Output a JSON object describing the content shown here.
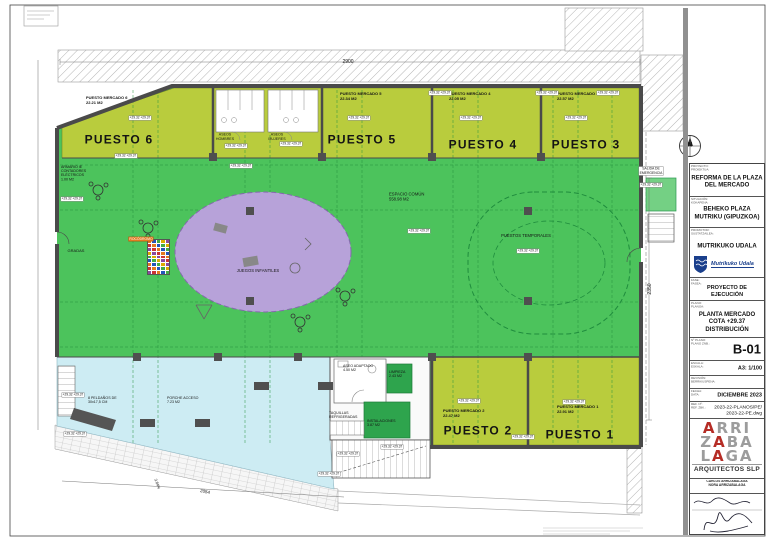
{
  "colors": {
    "stall_yellow": "#b9cc3d",
    "hall_green": "#4cc35c",
    "room_green": "#2ea44d",
    "exit_green": "#74d084",
    "play_purple": "#b7a2d9",
    "terrace_cyan": "#cdecf3",
    "wall_gray": "#4a4a4a",
    "tag_orange": "#e2791f",
    "brand_red": "#b52c25",
    "brand_gray": "#9c9c9c",
    "logo_blue": "#1a3f8c"
  },
  "plan": {
    "level_tag_text": "+29.32 +29.37",
    "hold_colors": [
      "#e2791f",
      "#2255bb",
      "#44aa44",
      "#ddaa00",
      "#8a4a9e",
      "#cc3333"
    ],
    "labels": [
      {
        "t": "PUESTO 6",
        "x": 119,
        "y": 136,
        "s": 12,
        "b": 1,
        "n": "label-puesto-6"
      },
      {
        "t": "PUESTO 5",
        "x": 362,
        "y": 136,
        "s": 12,
        "b": 1,
        "n": "label-puesto-5"
      },
      {
        "t": "PUESTO 4",
        "x": 483,
        "y": 141,
        "s": 12,
        "b": 1,
        "n": "label-puesto-4"
      },
      {
        "t": "PUESTO 3",
        "x": 586,
        "y": 141,
        "s": 12,
        "b": 1,
        "n": "label-puesto-3"
      },
      {
        "t": "PUESTO 2",
        "x": 478,
        "y": 427,
        "s": 12,
        "b": 1,
        "n": "label-puesto-2"
      },
      {
        "t": "PUESTO 1",
        "x": 580,
        "y": 431,
        "s": 12,
        "b": 1,
        "n": "label-puesto-1"
      },
      {
        "t": "PUESTO MERCADO 6\n22.21 M2",
        "x": 86,
        "y": 96,
        "s": 4,
        "b": 1,
        "tl": 1,
        "n": "info-puesto-6"
      },
      {
        "t": "PUESTO MERCADO 5\n22.34 M2",
        "x": 340,
        "y": 92,
        "s": 4,
        "b": 1,
        "tl": 1,
        "n": "info-puesto-5"
      },
      {
        "t": "PUESTO MERCADO 4\n22.05 M2",
        "x": 449,
        "y": 92,
        "s": 4,
        "b": 1,
        "tl": 1,
        "n": "info-puesto-4"
      },
      {
        "t": "PUESTO MERCADO 3\n22.57 M2",
        "x": 557,
        "y": 92,
        "s": 4,
        "b": 1,
        "tl": 1,
        "n": "info-puesto-3"
      },
      {
        "t": "PUESTO MERCADO 2\n22.47 M2",
        "x": 443,
        "y": 409,
        "s": 4,
        "b": 1,
        "tl": 1,
        "n": "info-puesto-2"
      },
      {
        "t": "PUESTO MERCADO 1\n22.91 M2",
        "x": 557,
        "y": 405,
        "s": 4,
        "b": 1,
        "tl": 1,
        "n": "info-puesto-1"
      },
      {
        "t": "ASEOS\nHOMBRES",
        "x": 225,
        "y": 137,
        "s": 3.6,
        "n": "label-aseos-hombres"
      },
      {
        "t": "ASEOS\nMUJERES",
        "x": 277,
        "y": 137,
        "s": 3.6,
        "n": "label-aseos-mujeres"
      },
      {
        "t": "ARMARIO IE\nCONTADORES\nELÉCTRICOS\n1.00 M2",
        "x": 61,
        "y": 165,
        "s": 3.6,
        "tl": 1,
        "n": "label-armario-contadores"
      },
      {
        "t": "GRADAS",
        "x": 76,
        "y": 246,
        "s": 4,
        "n": "label-gradas"
      },
      {
        "t": "JUEGOS INFANTILES",
        "x": 258,
        "y": 266,
        "s": 4.2,
        "n": "label-juegos-infantiles"
      },
      {
        "t": "ESPACIO COMÚN\n558.98 M2",
        "x": 389,
        "y": 192,
        "s": 4.2,
        "tl": 1,
        "n": "label-espacio-comun"
      },
      {
        "t": "PUESTOS TEMPORALES",
        "x": 526,
        "y": 231,
        "s": 4.2,
        "n": "label-puestos-temporales"
      },
      {
        "t": "ASEO ADAPTADO\n4.50 M2",
        "x": 343,
        "y": 364,
        "s": 3.6,
        "tl": 1,
        "n": "label-aseo-adaptado"
      },
      {
        "t": "LIMPIEZA\n2.43 M2",
        "x": 389,
        "y": 370,
        "s": 3.6,
        "tl": 1,
        "n": "label-limpieza"
      },
      {
        "t": "INSTALACIONES\n3.87 M2",
        "x": 367,
        "y": 419,
        "s": 3.6,
        "tl": 1,
        "n": "label-instalaciones"
      },
      {
        "t": "TAQUILLAS\nREFRIGERADAS",
        "x": 329,
        "y": 411,
        "s": 3.6,
        "tl": 1,
        "n": "label-taquillas"
      },
      {
        "t": "8 PELDAÑOS DE\n30x17,5 CM",
        "x": 88,
        "y": 396,
        "s": 3.6,
        "tl": 1,
        "n": "label-peldanos"
      },
      {
        "t": "PORCHE ACCESO\n7.23 M2",
        "x": 167,
        "y": 396,
        "s": 3.6,
        "tl": 1,
        "n": "label-porche-acceso"
      },
      {
        "t": "SALIDA DE\nEMERGENCIA",
        "x": 651,
        "y": 171,
        "s": 3.4,
        "bg": "tag",
        "n": "label-salida-emergencia"
      },
      {
        "t": "ROCÓDROMO",
        "x": 141,
        "y": 235,
        "s": 3.4,
        "bg": "orange",
        "n": "label-rocodromo"
      },
      {
        "t": "2900",
        "x": 348,
        "y": 57,
        "s": 5,
        "n": "dim-top"
      },
      {
        "t": "2350",
        "x": 650,
        "y": 284,
        "s": 5,
        "rot": -90,
        "n": "dim-right"
      },
      {
        "t": "2054",
        "x": 205,
        "y": 487,
        "s": 4.5,
        "rot": 11,
        "n": "dim-bottom"
      },
      {
        "t": "3.84%",
        "x": 157,
        "y": 479,
        "s": 3.8,
        "rot": 70,
        "n": "label-slope"
      },
      {
        "t": "N",
        "x": 690,
        "y": 140,
        "s": 6,
        "b": 1,
        "n": "compass-n-label"
      },
      {
        "tag": 1,
        "x": 140,
        "y": 114,
        "s": 3.2
      },
      {
        "tag": 1,
        "x": 126,
        "y": 152,
        "s": 3.2
      },
      {
        "tag": 1,
        "x": 236,
        "y": 142,
        "s": 3.2
      },
      {
        "tag": 1,
        "x": 291,
        "y": 140,
        "s": 3.2
      },
      {
        "tag": 1,
        "x": 241,
        "y": 162,
        "s": 3.2
      },
      {
        "tag": 1,
        "x": 359,
        "y": 114,
        "s": 3.2
      },
      {
        "tag": 1,
        "x": 471,
        "y": 114,
        "s": 3.2
      },
      {
        "tag": 1,
        "x": 576,
        "y": 114,
        "s": 3.2
      },
      {
        "tag": 1,
        "x": 440,
        "y": 89,
        "s": 3.2
      },
      {
        "tag": 1,
        "x": 547,
        "y": 89,
        "s": 3.2
      },
      {
        "tag": 1,
        "x": 608,
        "y": 89,
        "s": 3.2
      },
      {
        "tag": 1,
        "x": 419,
        "y": 227,
        "s": 3.2
      },
      {
        "tag": 1,
        "x": 528,
        "y": 247,
        "s": 3.2
      },
      {
        "tag": 1,
        "x": 651,
        "y": 181,
        "s": 3.2
      },
      {
        "tag": 1,
        "x": 469,
        "y": 397,
        "s": 3.2
      },
      {
        "tag": 1,
        "x": 574,
        "y": 398,
        "s": 3.2
      },
      {
        "tag": 1,
        "x": 523,
        "y": 433,
        "s": 3.2
      },
      {
        "tag": 1,
        "x": 392,
        "y": 443,
        "s": 3.2
      },
      {
        "tag": 1,
        "x": 348,
        "y": 450,
        "s": 3.2
      },
      {
        "tag": 1,
        "x": 72,
        "y": 195,
        "s": 3.2
      },
      {
        "tag": 1,
        "x": 73,
        "y": 391,
        "s": 3.2
      },
      {
        "tag": 1,
        "x": 75,
        "y": 430,
        "s": 3.2
      },
      {
        "tag": 1,
        "x": 329,
        "y": 470,
        "s": 3.2
      }
    ]
  },
  "title_block": {
    "fields": [
      {
        "k": "PROYECTO:",
        "k2": "PROIEKTUA:",
        "v": "REFORMA DE LA PLAZA\nDEL MERCADO"
      },
      {
        "k": "SITUACIÓN:",
        "k2": "KOKAPENA:",
        "v": "BEHEKO PLAZA\nMUTRIKU (GIPUZKOA)"
      },
      {
        "k": "PROMOTOR:",
        "k2": "SUSTATZAILEA:",
        "v": "MUTRIKUKO UDALA"
      },
      {
        "k": "FASE:",
        "k2": "FASEA:",
        "v": "PROYECTO DE EJECUCIÓN"
      },
      {
        "k": "PLANO:",
        "k2": "PLANOA:",
        "v": "PLANTA MERCADO\nCOTA +29.37\nDISTRIBUCIÓN"
      },
      {
        "k": "Nº PLANO:",
        "k2": "PLANO ZNB.:",
        "v": "B-01"
      },
      {
        "k": "ESCALA:",
        "k2": "ESKALA:",
        "v": "A3: 1/100"
      },
      {
        "k": "REVISIÓN:",
        "k2": "BERRIKUSPENA:",
        "v": ""
      },
      {
        "k": "FECHA:",
        "k2": "DATA:",
        "v": "DICIEMBRE 2023"
      },
      {
        "k": "REF. Nº:",
        "k2": "REF. ZBK.:",
        "v": "2023-22-PLANOS/PE/\n2023-22-PE.dwg"
      }
    ],
    "promoter_logo_text": "Mutrikuko Udala",
    "firm": {
      "rows": [
        {
          "a": "",
          "r": "A",
          "b": "RRI"
        },
        {
          "a": "Z",
          "r": "A",
          "b": "BA"
        },
        {
          "a": "L",
          "r": "A",
          "b": "GA"
        }
      ],
      "subtitle": "ARQUITECTOS SLP",
      "architects": [
        "CARLOS ARRIZABALAGA",
        "NORA ARRIZABALAGA"
      ]
    }
  }
}
